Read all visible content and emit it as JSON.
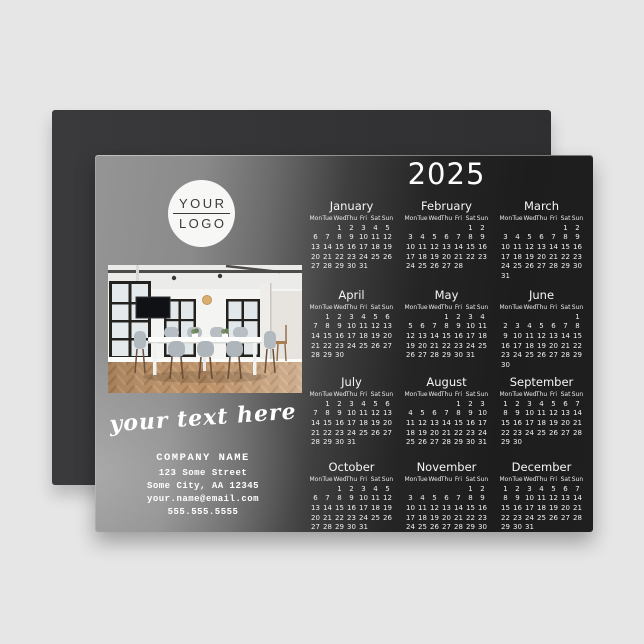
{
  "colors": {
    "page_bg": "#e6e6e7",
    "magnet_back": "#333335",
    "card_dark": "#1d1d1d",
    "card_light": "#959595",
    "text_light": "#f0f0f0",
    "logo_bg": "#f7f7f6",
    "logo_text": "#3b3b3b"
  },
  "logo": {
    "line1": "YOUR",
    "line2": "LOGO"
  },
  "photo_alt": "office-meeting-room-photo",
  "tagline": "your text here",
  "contact": {
    "company": "COMPANY NAME",
    "address1": "123 Some Street",
    "address2": "Some City, AA 12345",
    "email": "your.name@email.com",
    "phone": "555.555.5555"
  },
  "calendar": {
    "year": "2025",
    "day_headers": [
      "Mon",
      "Tue",
      "Wed",
      "Thu",
      "Fri",
      "Sat",
      "Sun"
    ],
    "months": [
      {
        "name": "January",
        "start": 2,
        "days": 31
      },
      {
        "name": "February",
        "start": 5,
        "days": 28
      },
      {
        "name": "March",
        "start": 5,
        "days": 31
      },
      {
        "name": "April",
        "start": 1,
        "days": 30
      },
      {
        "name": "May",
        "start": 3,
        "days": 31
      },
      {
        "name": "June",
        "start": 6,
        "days": 30
      },
      {
        "name": "July",
        "start": 1,
        "days": 31
      },
      {
        "name": "August",
        "start": 4,
        "days": 31
      },
      {
        "name": "September",
        "start": 0,
        "days": 30
      },
      {
        "name": "October",
        "start": 2,
        "days": 31
      },
      {
        "name": "November",
        "start": 5,
        "days": 30
      },
      {
        "name": "December",
        "start": 0,
        "days": 31
      }
    ]
  }
}
